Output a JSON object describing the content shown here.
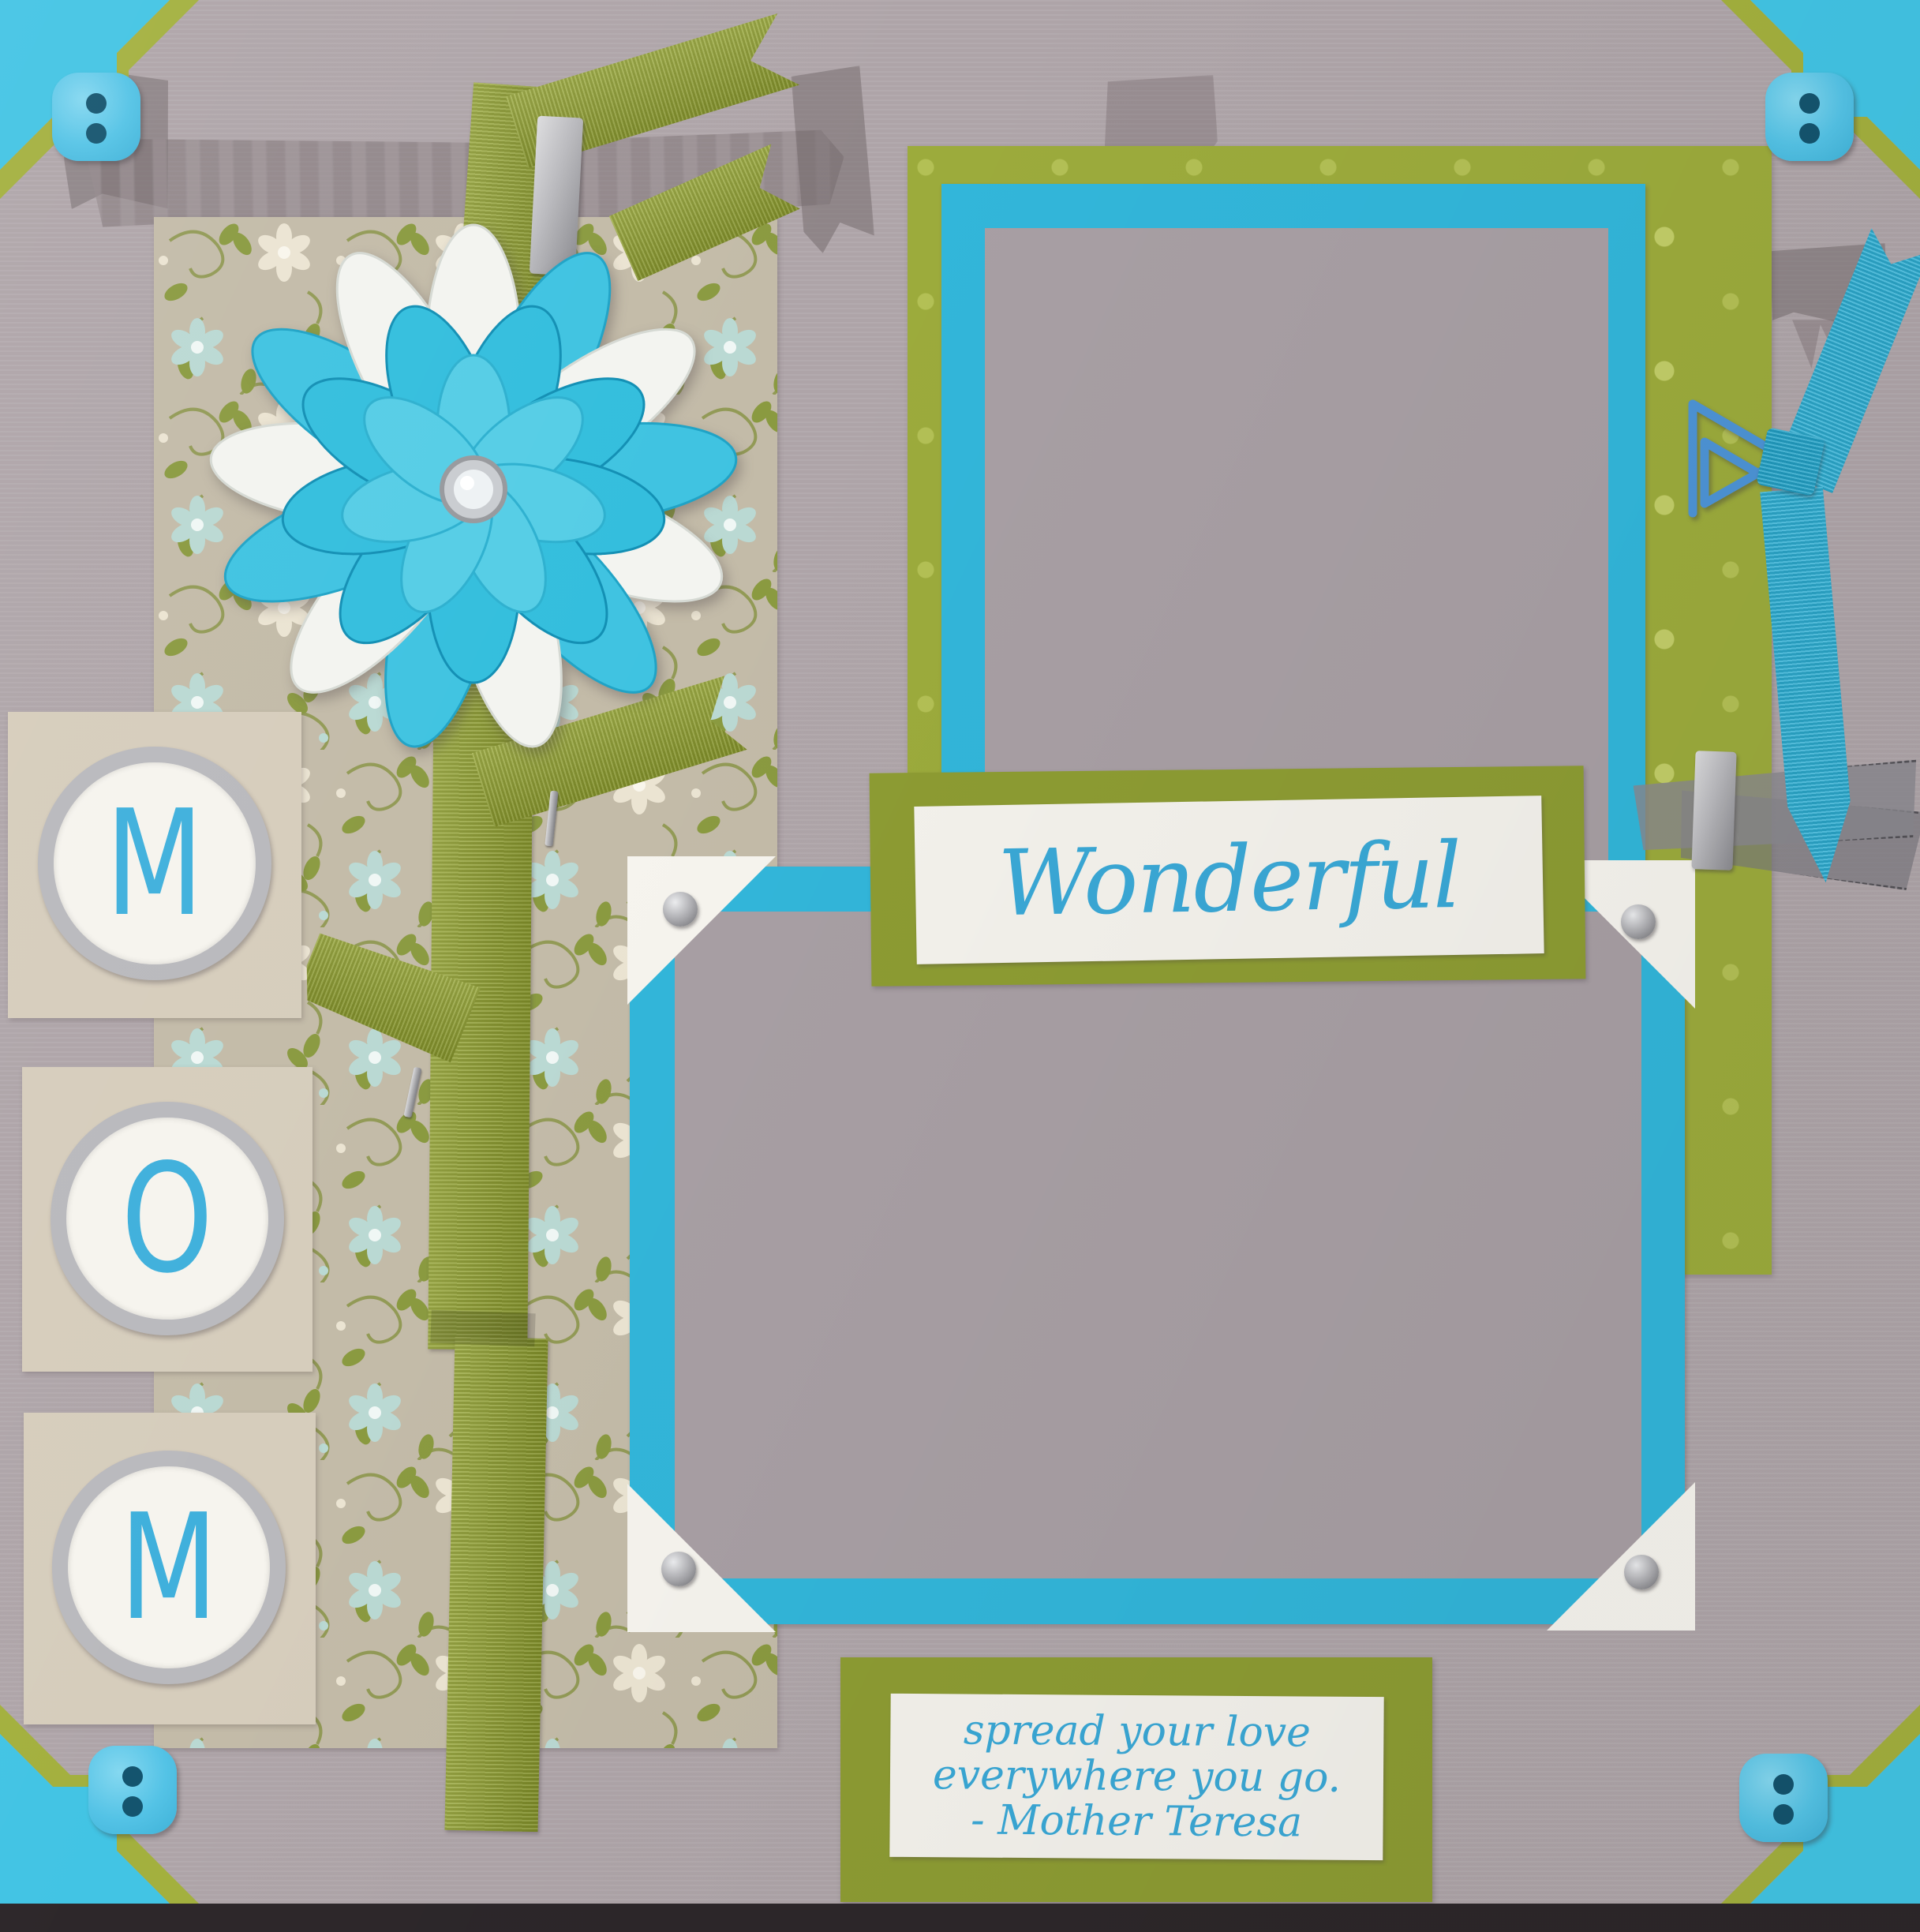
{
  "artwork": {
    "kind": "scrapbook page photograph",
    "theme": "Mother's Day layout",
    "title_word": "Wonderful",
    "monogram_letters": [
      "M",
      "O",
      "M"
    ],
    "quote_lines": [
      "spread your love",
      "everywhere you go.",
      "- Mother Teresa"
    ],
    "embellishments": [
      "paper flower",
      "grosgrain ribbon stem",
      "triangle paperclip",
      "blue bow",
      "buttons",
      "brads",
      "photo corners",
      "staples",
      "distressed stamp"
    ],
    "palette": {
      "background_gray": "#b1a7ab",
      "photo_placeholder_gray": "#a89fa4",
      "turquoise_mat": "#32b6da",
      "corner_blue": "#42c4e4",
      "button_blue": "#54c3e6",
      "olive_ribbon_green": "#92a22f",
      "polka_paper_green": "#9cab3c",
      "mat_green": "#8d9c33",
      "floral_paper_tan": "#c3bba8",
      "white_paper": "#f4f2ec",
      "ink_blue": "#3aa8d6",
      "silver": "#b9b9bd"
    }
  }
}
